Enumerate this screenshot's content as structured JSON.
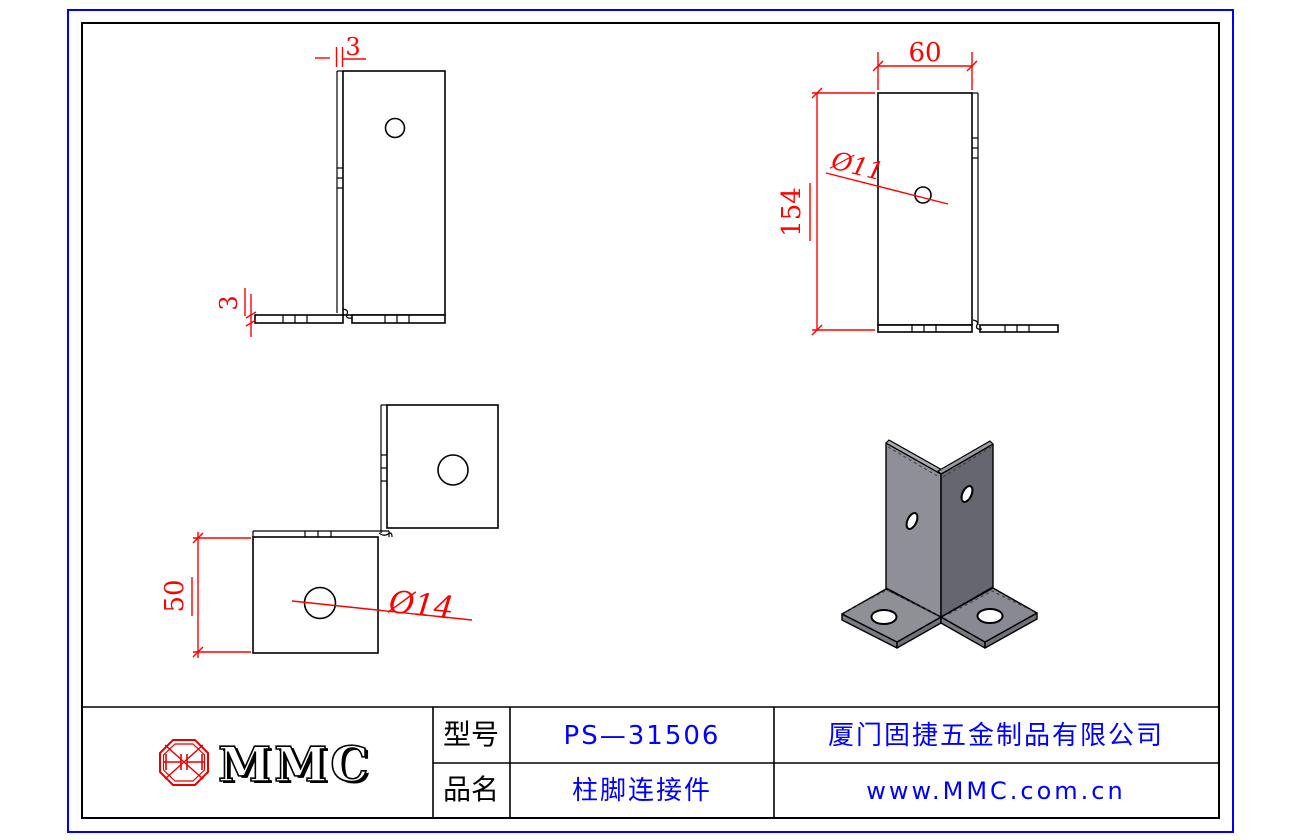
{
  "drawing": {
    "side_view": {
      "flange_thickness_label": "3",
      "base_thickness_label": "3"
    },
    "front_view": {
      "width_label": "60",
      "height_label": "154",
      "hole_label": "Ø11"
    },
    "top_view": {
      "depth_label": "50",
      "hole_label": "Ø14"
    }
  },
  "title_block": {
    "logo_text": "MMC",
    "model_label": "型号",
    "model_value": "PS—31506",
    "name_label": "品名",
    "name_value": "柱脚连接件",
    "company_name": "厦门固捷五金制品有限公司",
    "website": "www.MMC.com.cn"
  },
  "colors": {
    "dimension_red": "#ff0000",
    "logo_red": "#e60000",
    "text_blue": "#0000ff",
    "line_black": "#000000",
    "iso_face_left": "#8f9097",
    "iso_face_right": "#656670",
    "iso_top_bevel": "#aaabb2",
    "iso_flange_top": "#8f9097"
  }
}
